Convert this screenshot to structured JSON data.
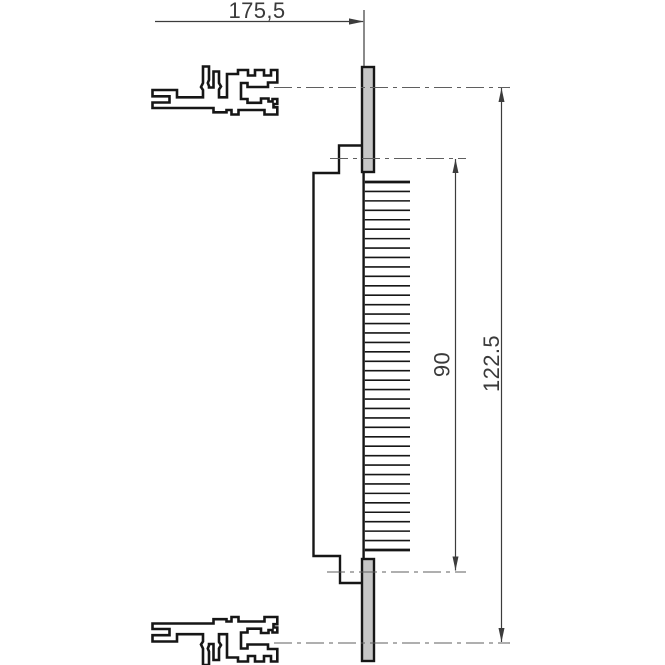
{
  "drawing": {
    "kind": "technical-dimension-drawing",
    "labels": {
      "width_mm": "175,5",
      "pin_field_mm": "90",
      "overall_height_mm": "122.5"
    },
    "pin_count": 40,
    "colors": {
      "outline": "#161616",
      "thin_line": "#3c3c3c",
      "centerline": "#5f5f5f",
      "plate_fill": "#c6c6c6",
      "text": "#3a3a3a",
      "background": "#ffffff"
    }
  }
}
